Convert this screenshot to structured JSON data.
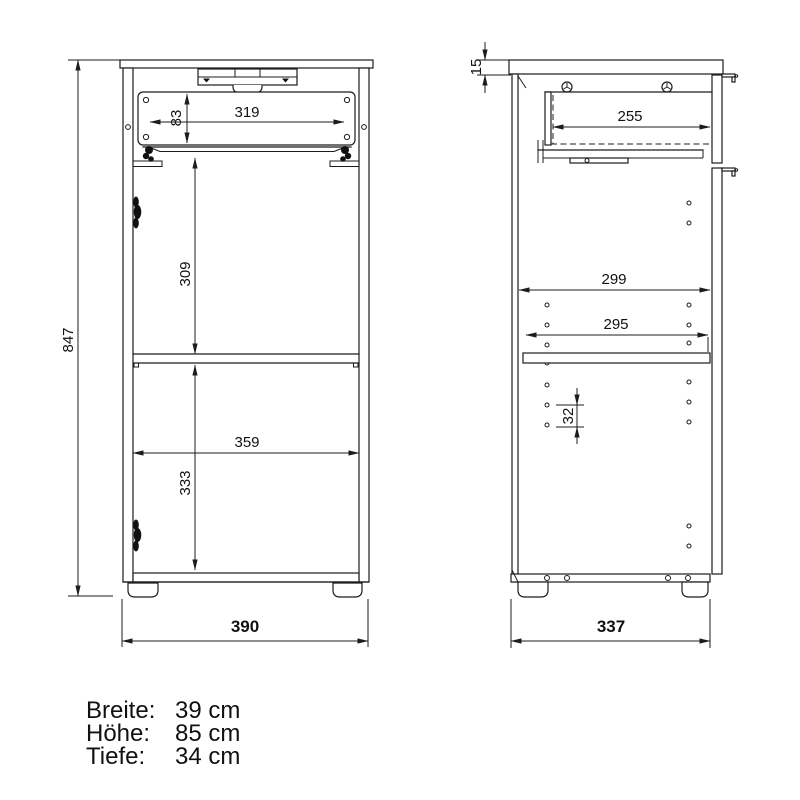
{
  "drawing": {
    "front_view": {
      "overall_height": "847",
      "drawer_front_height": "83",
      "drawer_inner_width": "319",
      "upper_compartment_height": "309",
      "interior_width": "359",
      "lower_compartment_height": "333",
      "overall_width": "390"
    },
    "side_view": {
      "top_panel_thickness": "15",
      "drawer_depth": "255",
      "interior_depth": "299",
      "shelf_depth": "295",
      "hole_pitch": "32",
      "overall_depth": "337"
    }
  },
  "specs": {
    "rows": [
      {
        "label": "Breite:",
        "value": "39 cm"
      },
      {
        "label": "Höhe:",
        "value": "85 cm"
      },
      {
        "label": "Tiefe:",
        "value": "34 cm"
      }
    ]
  },
  "colors": {
    "line": "#1c1c1c",
    "background": "#ffffff"
  }
}
